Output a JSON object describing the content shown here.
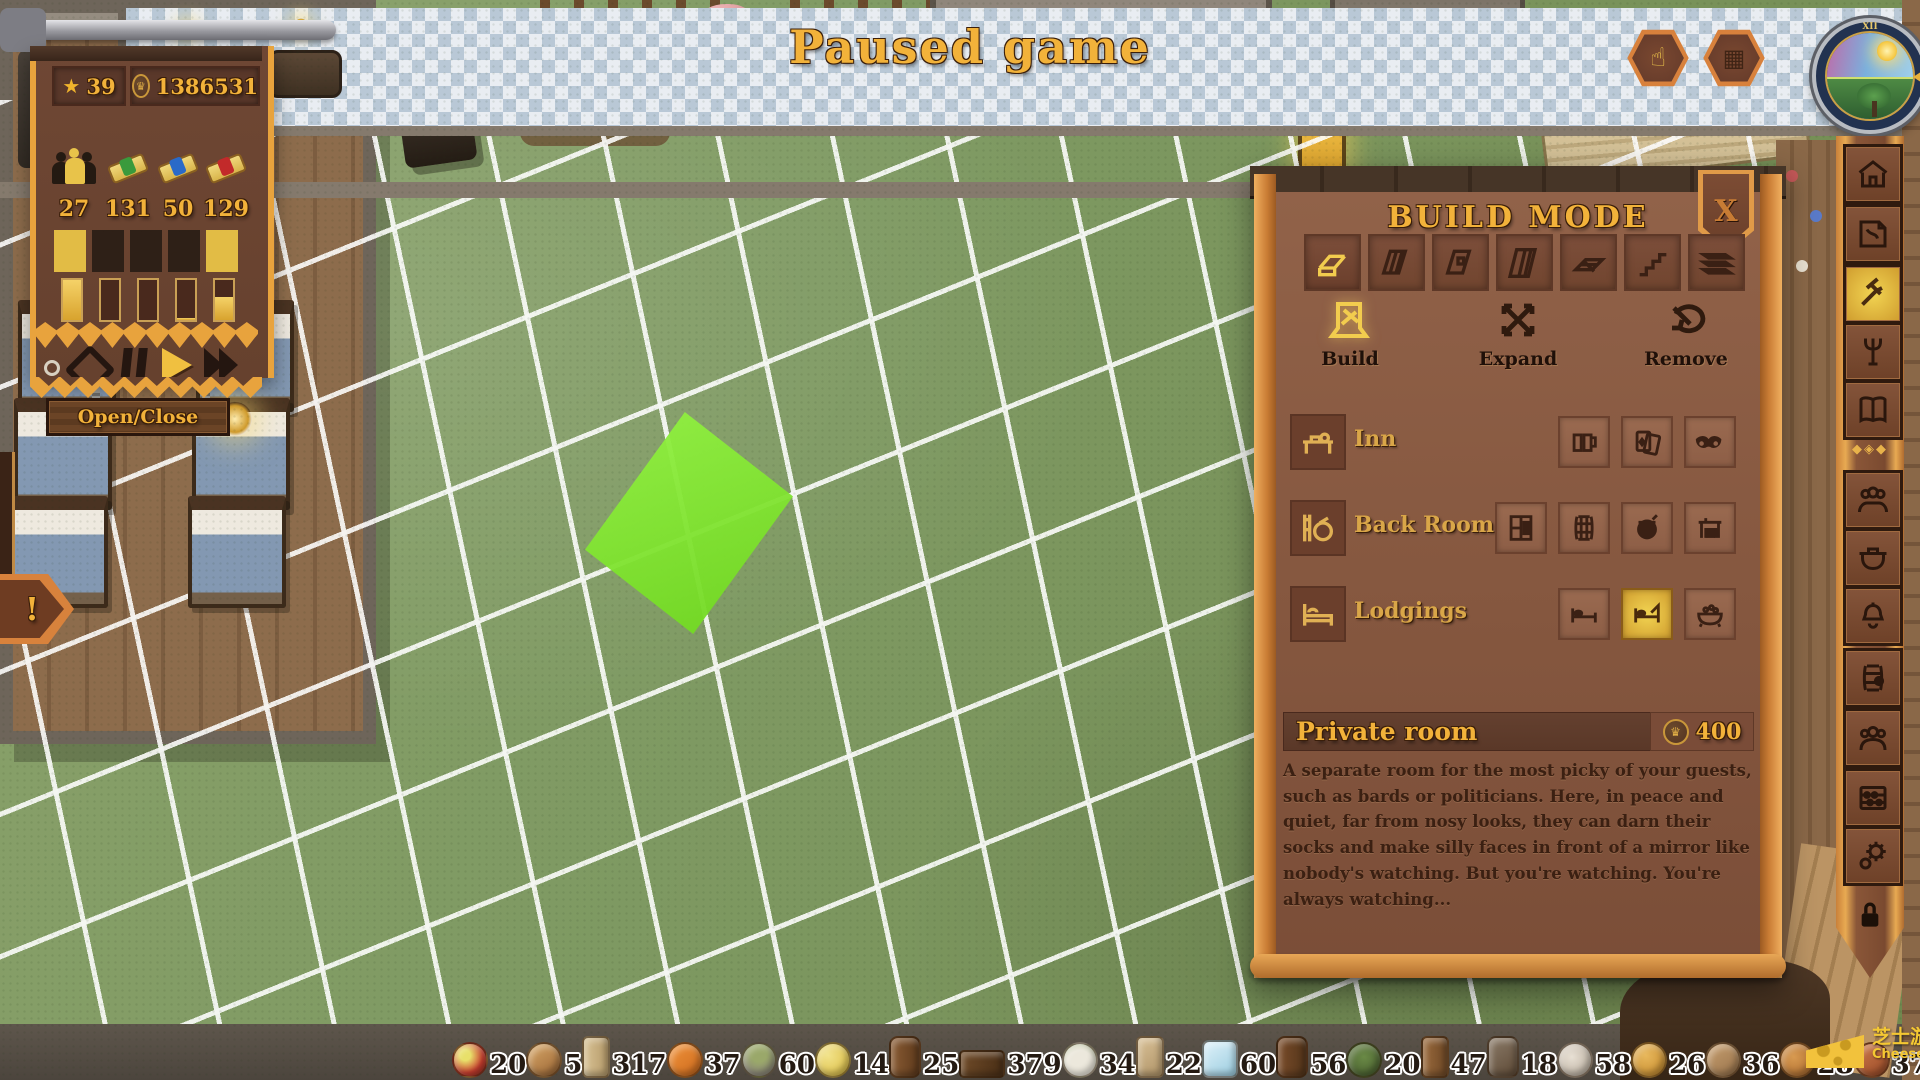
{
  "colors": {
    "accent_gold": "#f2b23a",
    "panel_brown": "#85573f",
    "banner_brown": "#6b4432",
    "border_orange": "#d8823c",
    "highlight_green": "#7ee332",
    "grass_green": "#7f9a63"
  },
  "hud": {
    "title": "Paused game",
    "top_left": {
      "star": "39",
      "coins": "1386531",
      "stats": [
        {
          "name": "guests",
          "value": "27"
        },
        {
          "name": "contracts-green",
          "value": "131"
        },
        {
          "name": "contracts-blue",
          "value": "50"
        },
        {
          "name": "contracts-red",
          "value": "129"
        }
      ],
      "gauges": [
        "100%",
        "0%",
        "0%",
        "5%",
        "58%"
      ],
      "open_close": "Open/Close"
    },
    "alert": "!",
    "clock": {
      "numeral": "XII"
    },
    "watermark": {
      "cn": "芝士游戏~",
      "site": "CheeseGame.org"
    }
  },
  "build_panel": {
    "title": "BUILD MODE",
    "close": "X",
    "tabs": [
      "rooms",
      "interior-walls",
      "windows",
      "exterior-walls",
      "floors",
      "stairs",
      "roofs"
    ],
    "modes": [
      {
        "label": "Build"
      },
      {
        "label": "Expand"
      },
      {
        "label": "Remove"
      }
    ],
    "categories": [
      {
        "label": "Inn",
        "items": [
          "tavern-hall",
          "game-room",
          "cabaret"
        ]
      },
      {
        "label": "Back Rooms",
        "items": [
          "pantry",
          "cellar",
          "kitchen",
          "workshop"
        ]
      },
      {
        "label": "Lodgings",
        "items": [
          "common-bedroom",
          "private-room",
          "bathhouse"
        ]
      }
    ],
    "selected": {
      "name": "Private room",
      "cost": "400",
      "description": "A separate room for the most picky of your guests, such as bards or politicians. Here, in peace and quiet, far from nosy looks, they can darn their socks and make silly faces in front of a mirror like nobody's watching. But you're watching. You're always watching..."
    }
  },
  "toolbar": [
    "inn",
    "blueprints",
    "build",
    "furnishings",
    "ledger",
    "staff",
    "kitchen",
    "service",
    "supplies",
    "guests",
    "finances",
    "settings",
    "lock"
  ],
  "resources": [
    {
      "name": "apples",
      "count": "20"
    },
    {
      "name": "bread",
      "count": "5"
    },
    {
      "name": "timber",
      "count": "317"
    },
    {
      "name": "carrots",
      "count": "37"
    },
    {
      "name": "grain",
      "count": "60"
    },
    {
      "name": "cheese",
      "count": "14"
    },
    {
      "name": "barrel",
      "count": "25"
    },
    {
      "name": "firewood",
      "count": "379"
    },
    {
      "name": "spring-onion",
      "count": "34"
    },
    {
      "name": "seed-sack",
      "count": "22"
    },
    {
      "name": "ice",
      "count": "60"
    },
    {
      "name": "beer-keg",
      "count": "56"
    },
    {
      "name": "herbs",
      "count": "20"
    },
    {
      "name": "butter-churn",
      "count": "47"
    },
    {
      "name": "vinegar",
      "count": "18"
    },
    {
      "name": "mushrooms",
      "count": "58"
    },
    {
      "name": "onions",
      "count": "26"
    },
    {
      "name": "tableware",
      "count": "36"
    },
    {
      "name": "poultry",
      "count": "28"
    },
    {
      "name": "sausage",
      "count": "37"
    },
    {
      "name": "meat",
      "count": "30"
    },
    {
      "name": "wine",
      "count": "57"
    },
    {
      "name": "cider",
      "count": "45"
    },
    {
      "name": "planks",
      "count": "0"
    }
  ]
}
